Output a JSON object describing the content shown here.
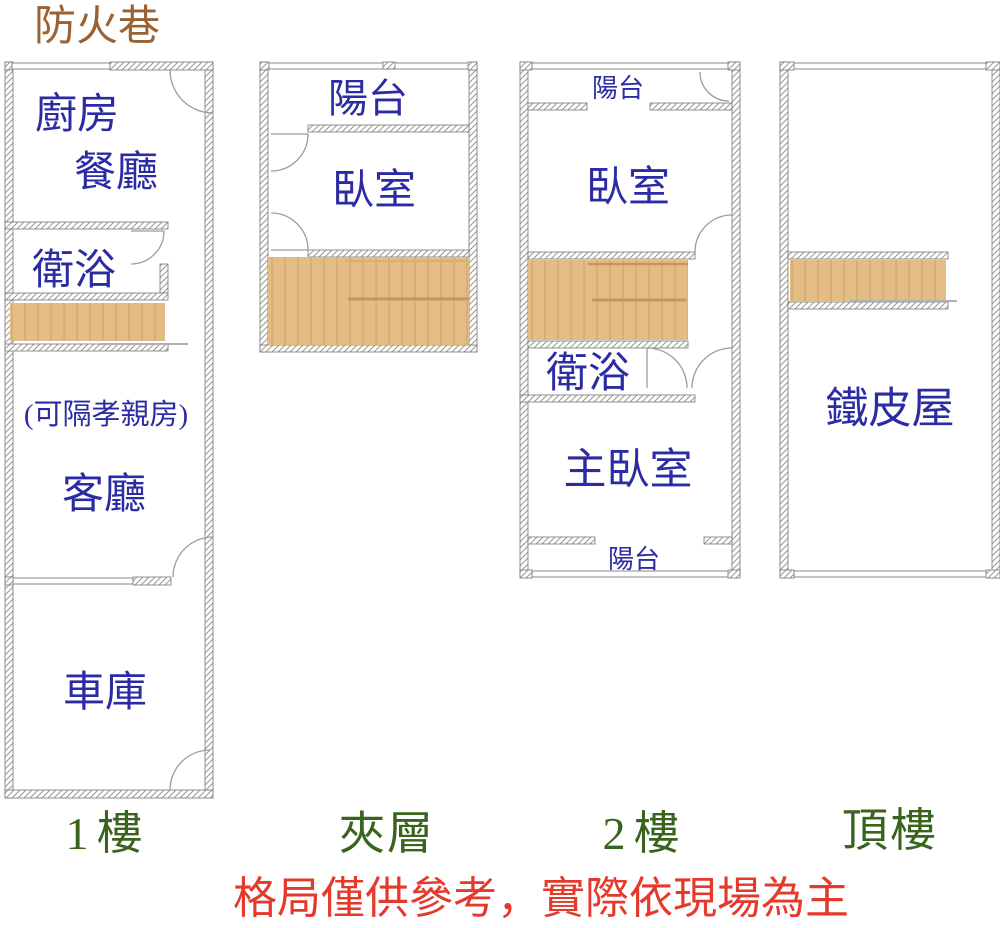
{
  "alley_label": "防火巷",
  "disclaimer": "格局僅供參考，實際依現場為主",
  "colors": {
    "room_text": "#2B2BA4",
    "floor_title": "#3A641E",
    "alley_text": "#9A6233",
    "disclaimer_text": "#E5392B",
    "stair_fill": "#E4BC85",
    "stair_tread": "#D8AE74",
    "stair_divider": "#C6975C",
    "stair_shadow": "#B0B0B0",
    "wall_hatch": "#8E8E8E"
  },
  "floors": {
    "f1": {
      "title": "1樓",
      "kitchen": "廚房",
      "dining": "餐廳",
      "bathroom": "衛浴",
      "note": "(可隔孝親房)",
      "living": "客廳",
      "garage": "車庫"
    },
    "mezzanine": {
      "title": "夾層",
      "balcony": "陽台",
      "bedroom": "臥室"
    },
    "f2": {
      "title": "2樓",
      "balcony_top": "陽台",
      "bedroom": "臥室",
      "bathroom": "衛浴",
      "master": "主臥室",
      "balcony_bottom": "陽台"
    },
    "roof": {
      "title": "頂樓",
      "shed": "鐵皮屋"
    }
  }
}
